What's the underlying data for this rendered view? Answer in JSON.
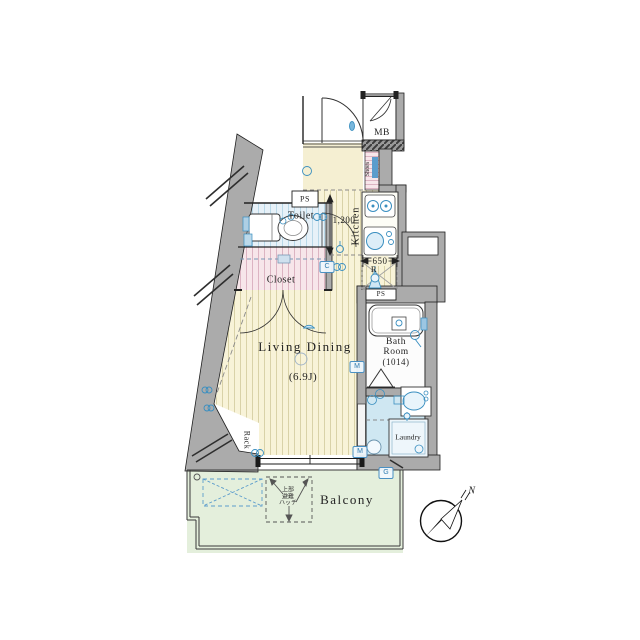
{
  "rooms": {
    "living": {
      "label": "Living Dining",
      "size": "(6.9J)"
    },
    "kitchen": {
      "label": "Kitchen"
    },
    "toilet": {
      "label": "Toilet"
    },
    "closet": {
      "label": "Closet"
    },
    "bath": {
      "line1": "Bath",
      "line2": "Room",
      "size": "(1014)"
    },
    "laundry": {
      "label": "Laundry"
    },
    "balcony": {
      "label": "Balcony"
    },
    "rack": {
      "label": "Rack"
    },
    "shoes": {
      "label": "Shoes"
    },
    "mb": {
      "label": "MB"
    },
    "ps_entry": {
      "label": "PS"
    },
    "ps_bath": {
      "label": "PS"
    }
  },
  "dimensions": {
    "hall": "1,200",
    "kitchen": "650",
    "fridge": "R"
  },
  "meters": {
    "c": "C",
    "g": "G",
    "m_wall": "M",
    "m_window": "M"
  },
  "hatch": {
    "line1": "上部",
    "line2": "避難",
    "line3": "ハッチ"
  },
  "compass": {
    "north": "N"
  },
  "colors": {
    "floor": "#f8f3d8",
    "toilet": "#e7f1f8",
    "closet": "#f7e6ea",
    "wash": "#cfe7f2",
    "balcony": "#e4efdc",
    "wall": "#ababab",
    "fixture_blue": "#3a8fc0"
  }
}
